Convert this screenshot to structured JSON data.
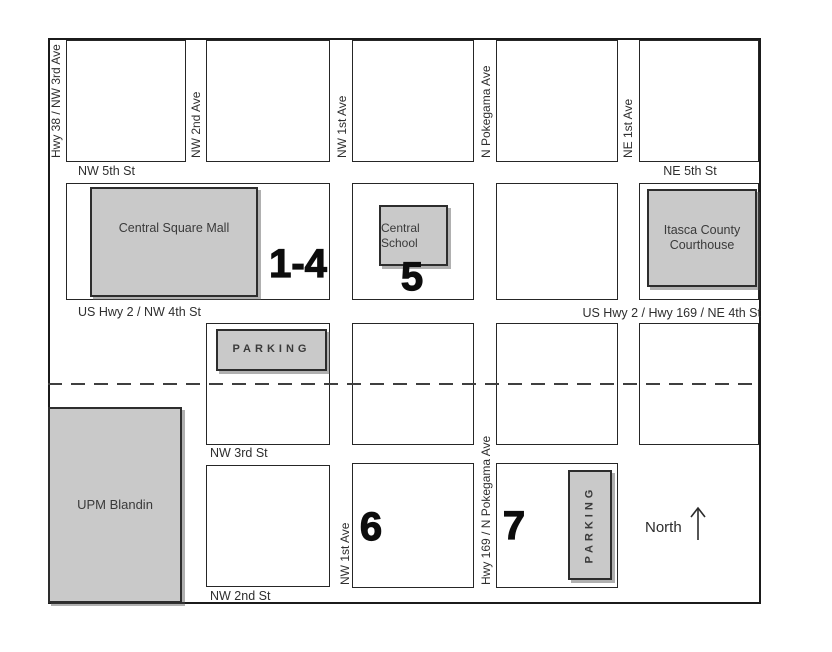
{
  "streets": {
    "nw5th": "NW 5th St",
    "ne5th": "NE 5th St",
    "hwy2_nw4th": "US Hwy 2 / NW 4th St",
    "hwy2_169_ne4th": "US Hwy 2 / Hwy 169 / NE 4th St",
    "nw3rd": "NW 3rd St",
    "nw2nd": "NW 2nd St"
  },
  "avenues": {
    "hwy38_nw3rd": "Hwy 38 / NW 3rd Ave",
    "nw2nd": "NW 2nd Ave",
    "nw1st_north": "NW 1st Ave",
    "n_pokegama": "N Pokegama Ave",
    "ne1st": "NE 1st Ave",
    "nw1st_south": "NW 1st Ave",
    "hwy169_pokegama": "Hwy 169 / N Pokegama Ave"
  },
  "buildings": {
    "central_square_mall": "Central Square Mall",
    "central_school": "Central School",
    "itasca_courthouse": "Itasca County Courthouse",
    "upm_blandin": "UPM Blandin",
    "parking_north": "PARKING",
    "parking_south": "PARKING"
  },
  "markers": {
    "mall_sites": "1-4",
    "school_site": "5",
    "site_six": "6",
    "site_seven": "7"
  },
  "compass": {
    "label": "North"
  },
  "colors": {
    "building_fill": "#c9c9c9",
    "line": "#1f1f1f",
    "text": "#3a3a3a"
  }
}
